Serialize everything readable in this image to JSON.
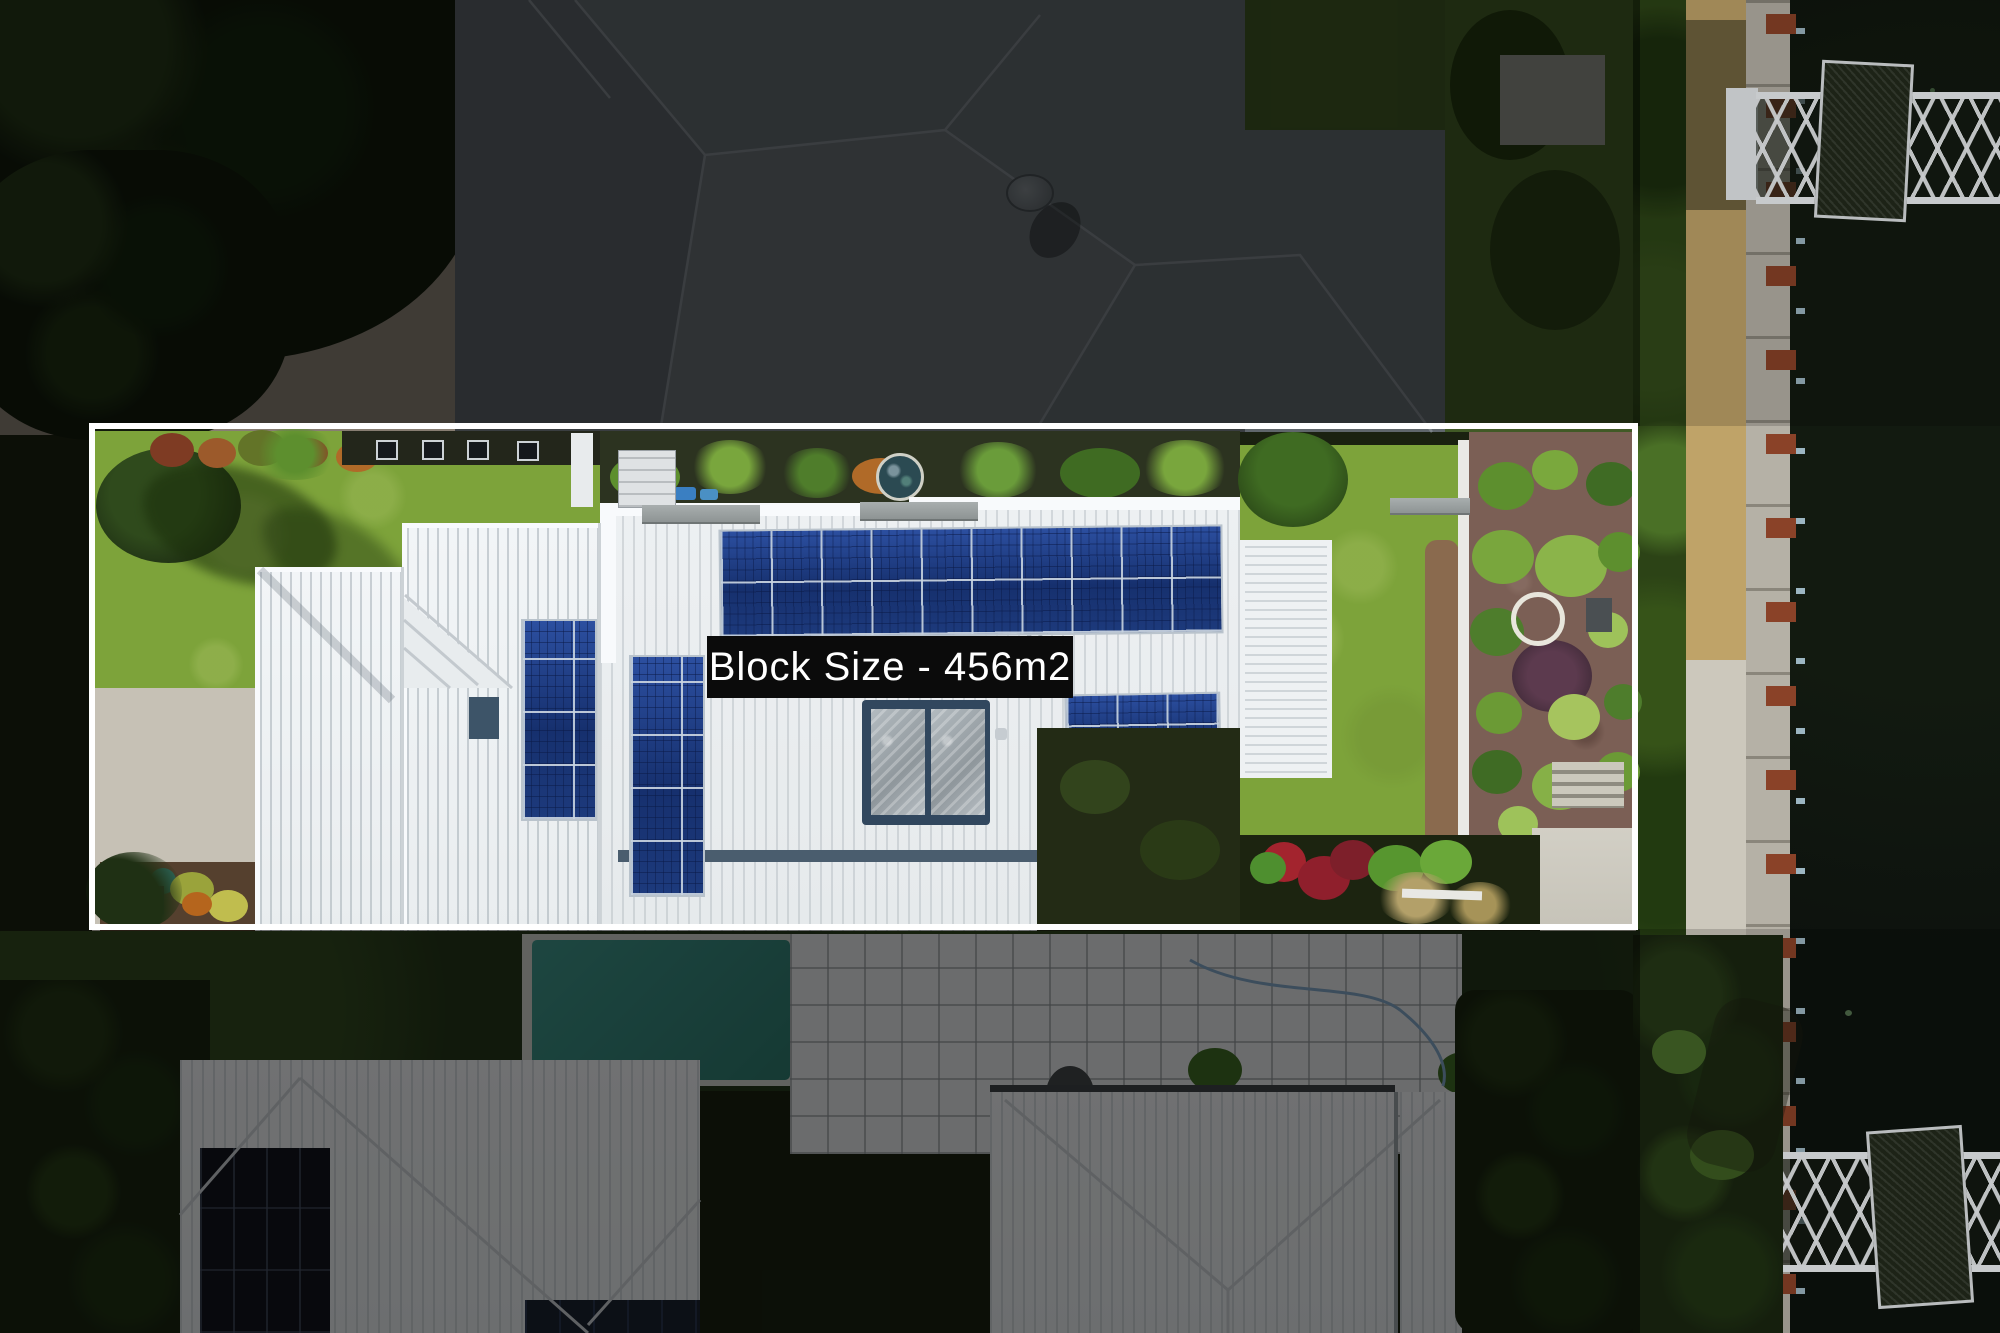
{
  "overlay": {
    "block_size_label": "Block Size - 456m2"
  },
  "scene": {
    "type": "aerial-drone-photo",
    "subject": "waterfront-property-marketing-shot-with-block-boundary-outline",
    "features": [
      "white-boundary-outline",
      "white-metal-roof",
      "rooftop-solar-array-long-row",
      "rooftop-solar-array-left-columns",
      "rooftop-solar-array-right",
      "solar-hot-water-collectors",
      "front-lawn",
      "rear-garden-mulch-beds",
      "white-ring-garden-ornament",
      "mosaic-garden-ornament",
      "waterfront-footpath",
      "canal-water",
      "timber-mooring-posts",
      "jetty-north",
      "jetty-south",
      "blue-street-lamp",
      "neighbouring-grey-roof-north",
      "satellite-dish",
      "neighbouring-houses-south",
      "swimming-pool",
      "tiled-pool-patio",
      "palm-trees",
      "dimmed-surroundings"
    ]
  },
  "palette": {
    "boundary": "#ffffff",
    "label_bg": "#0b0b0b",
    "label_text": "#ffffff",
    "lawn": "#7da33a",
    "roof_white": "#eef1f3",
    "solar_blue": "#1d3a7c",
    "neighbour_roof": "#5f666b",
    "water": "#0d120e",
    "path_tan": "#bfa368",
    "path_concrete": "#ccc8bc",
    "mulch": "#7b5f55",
    "post_rust": "#8a4228",
    "lamp_blue": "#4a90c4",
    "pool_teal": "#3f958a"
  }
}
